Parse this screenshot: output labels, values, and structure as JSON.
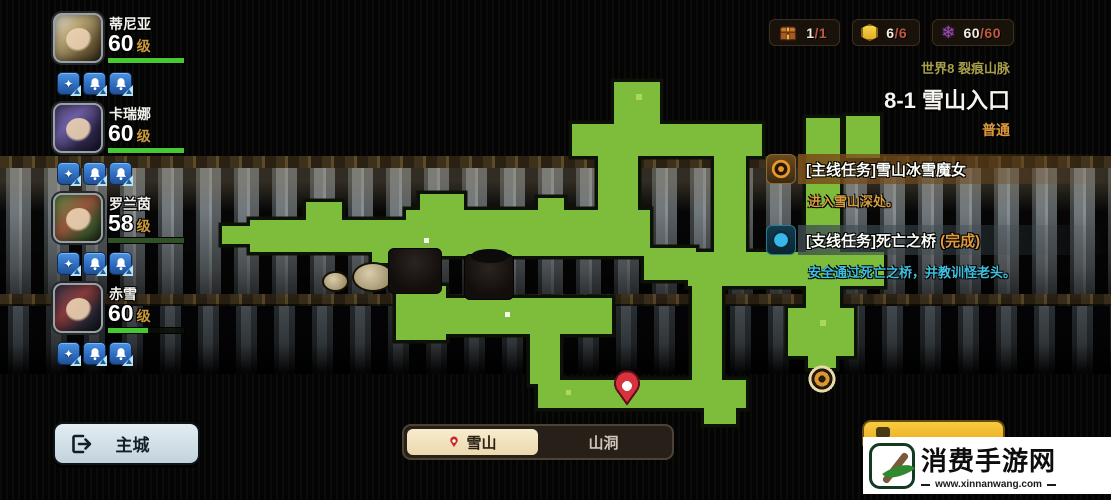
{
  "party": {
    "members": [
      {
        "name": "蒂尼亚",
        "level": "60",
        "hp": {
          "width": "100%",
          "color": "#46c832"
        }
      },
      {
        "name": "卡瑞娜",
        "level": "60",
        "hp": {
          "width": "100%",
          "color": "#46c832"
        }
      },
      {
        "name": "罗兰茵",
        "level": "58",
        "hp": {
          "width": "100%",
          "color": "#2e5226"
        }
      },
      {
        "name": "赤雪",
        "level": "60",
        "hp": {
          "width": "52%",
          "color": "#46c832"
        }
      }
    ],
    "level_suffix": "级",
    "skill_icons": [
      "emblem-icon",
      "bell-icon",
      "bell-icon"
    ],
    "emblem_glyph": "✦"
  },
  "resources": [
    {
      "icon": "chest-icon",
      "current": "1",
      "separator": "/",
      "total": "1"
    },
    {
      "icon": "honeycomb-icon",
      "current": "6",
      "separator": "/",
      "total": "6"
    },
    {
      "icon": "purple-snowflake-icon",
      "current": "60",
      "separator": "/",
      "total": "60"
    }
  ],
  "snowflake_glyph": "❄",
  "stage": {
    "world_label": "世界8 裂痕山脉",
    "stage_title": "8-1 雪山入口",
    "difficulty": "普通"
  },
  "quests": [
    {
      "tag": "[主线任务]",
      "title": "雪山冰雪魔女",
      "status": "",
      "desc": "进入雪山深处。",
      "icon": "main-quest-target-icon"
    },
    {
      "tag": "[支线任务]",
      "title": "死亡之桥",
      "status": " (完成)",
      "desc": "安全通过死亡之桥，并教训怪老头。",
      "icon": "side-quest-circle-icon"
    }
  ],
  "footer": {
    "home_label": "主城",
    "tabs": [
      {
        "label": "雪山",
        "active": true
      },
      {
        "label": "山洞",
        "active": false
      }
    ]
  },
  "watermark": {
    "site_name": "消费手游网",
    "site_url": "www.xinnanwang.com"
  },
  "colors": {
    "map_green": "#7dbd3b",
    "hp_green": "#46c832",
    "gold": "#c9983a",
    "orange": "#e09a3c",
    "cyan": "#3fc0e0",
    "pin_red": "#d8323f",
    "tab_active_bg": "#f3e2bd",
    "home_button_bg": "#ccdbe4",
    "yellow_button": "#f0b32a"
  }
}
